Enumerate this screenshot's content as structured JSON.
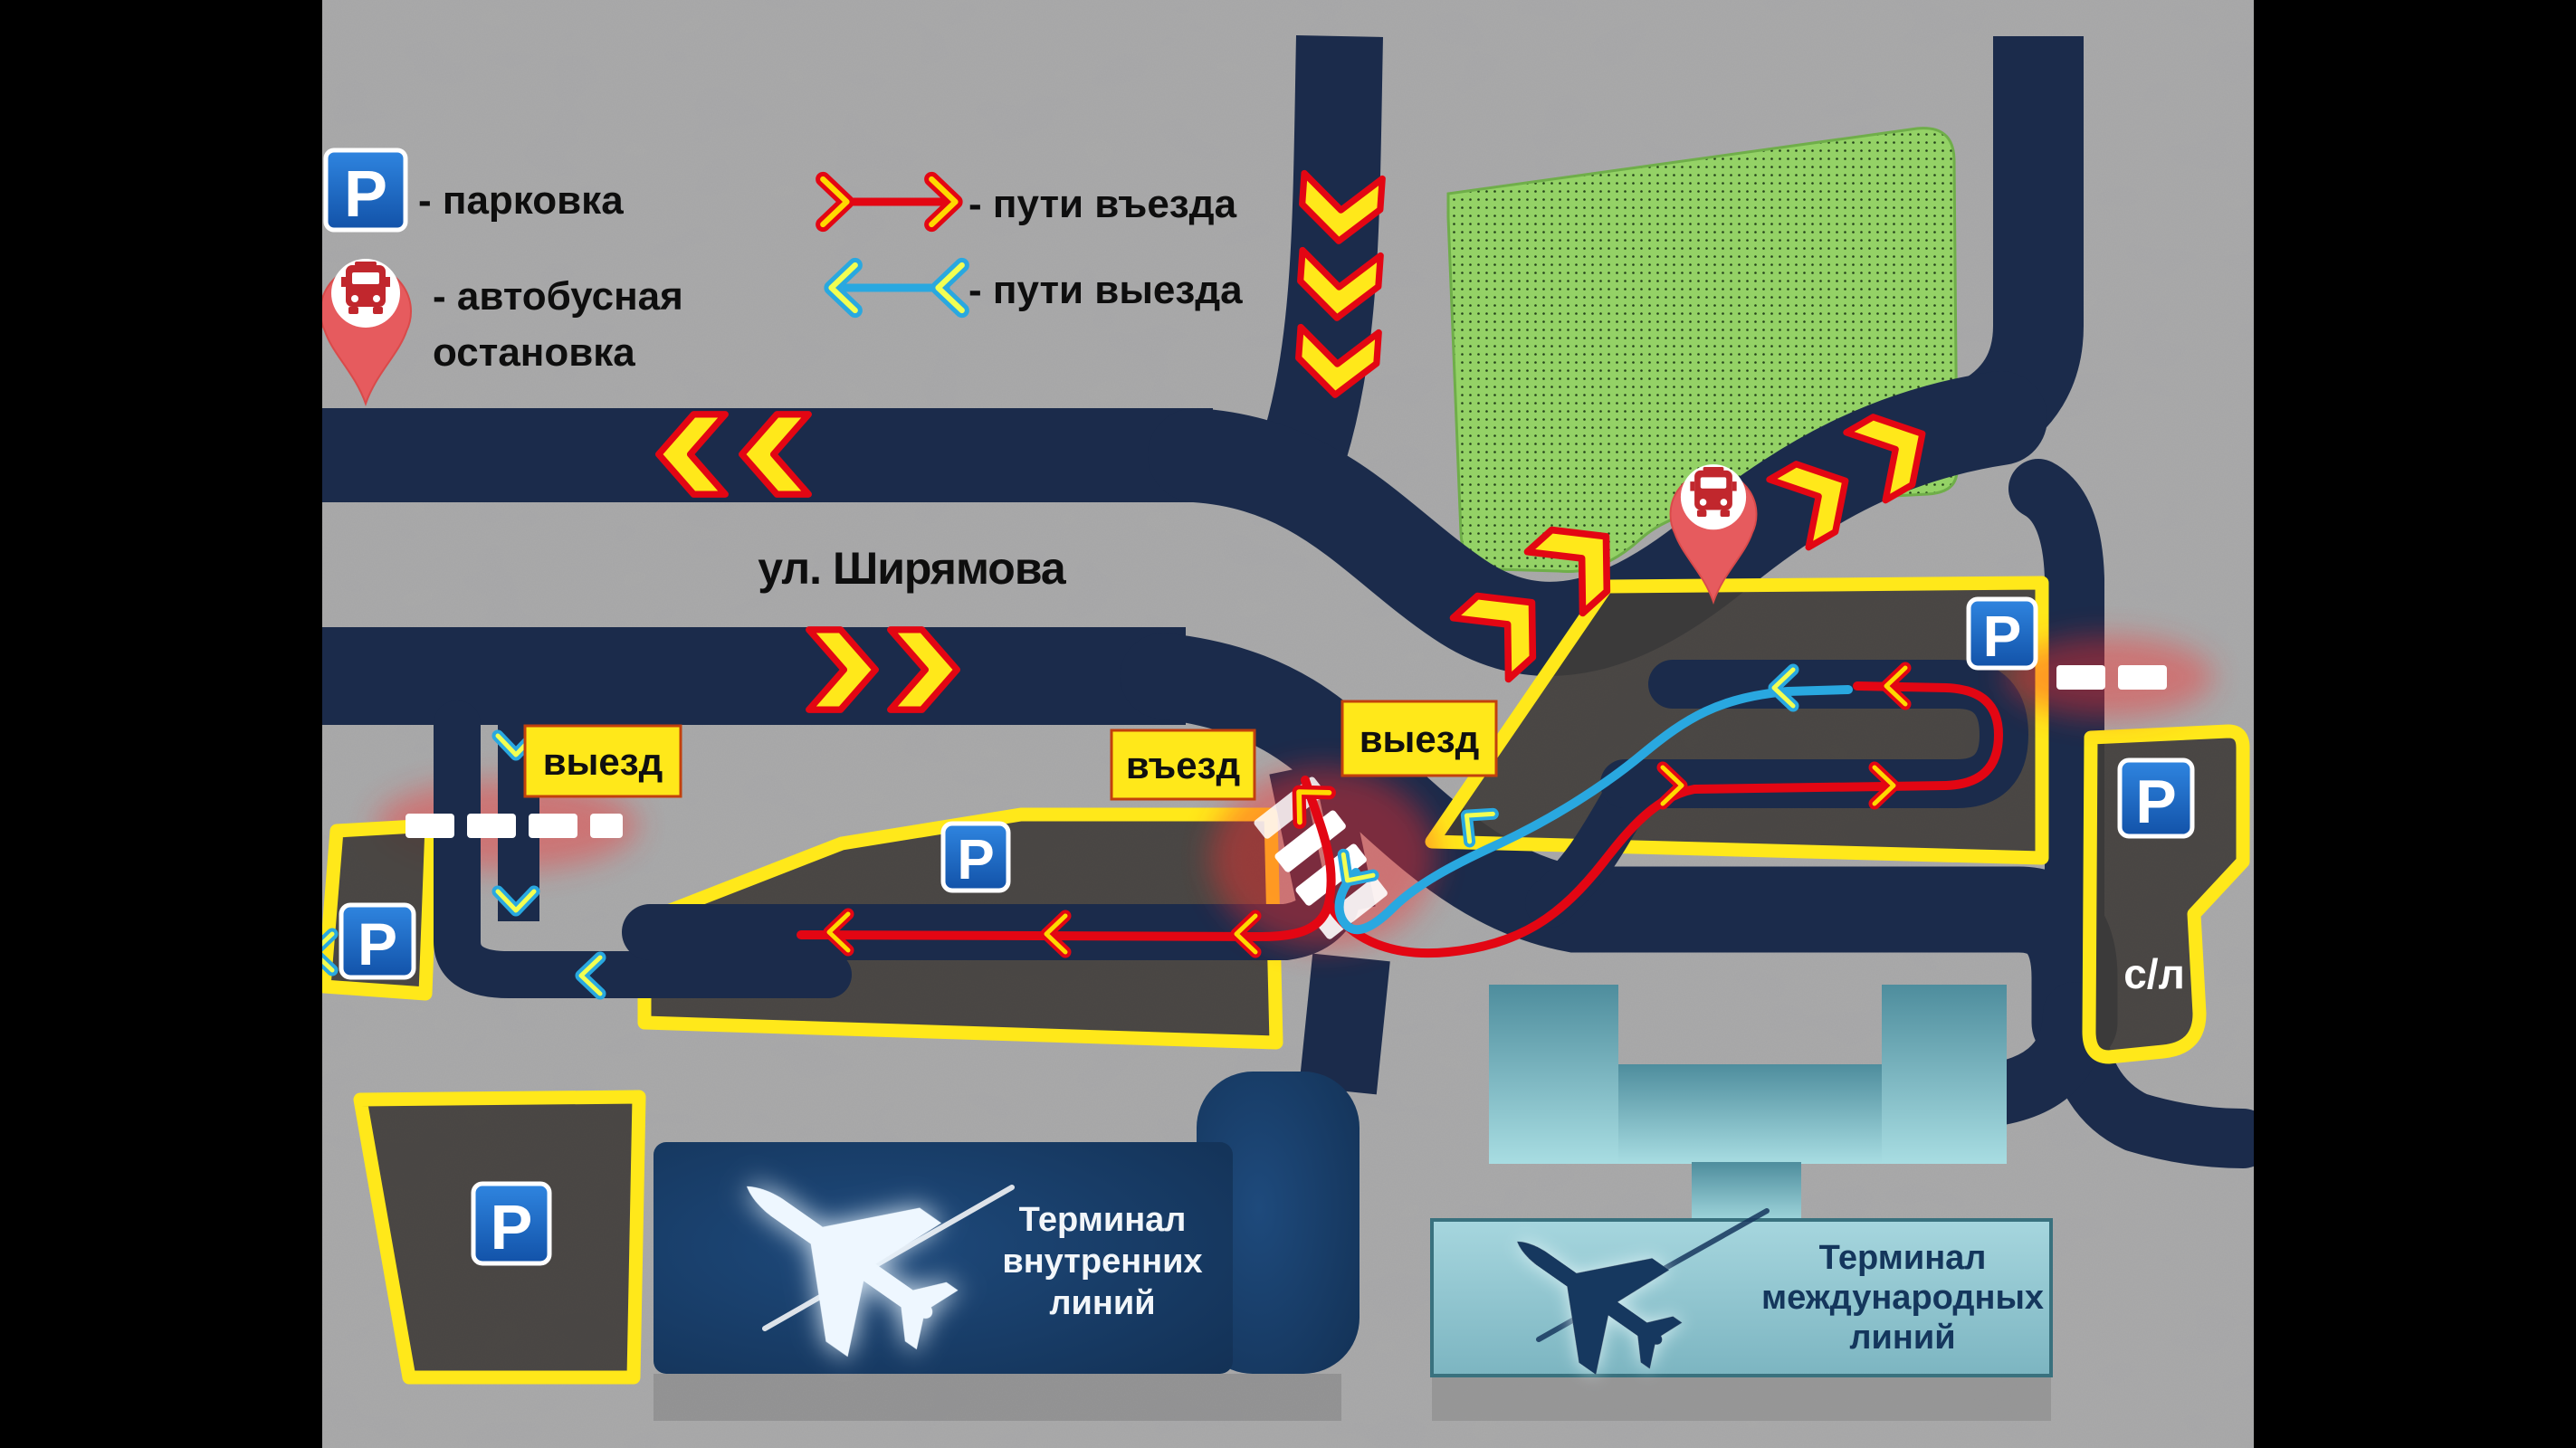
{
  "legend": {
    "parking_label": "- парковка",
    "bus_label_line1": "- автобусная",
    "bus_label_line2": "остановка",
    "entry_label": "- пути въезда",
    "exit_label": "- пути выезда"
  },
  "street": {
    "name": "ул. Ширямова"
  },
  "labels": {
    "parking_letter": "P",
    "exit_left": "выезд",
    "entry_center": "въезд",
    "exit_center": "выезд",
    "service_lot": "с/л"
  },
  "terminals": {
    "domestic": {
      "lines": [
        "Терминал",
        "внутренних",
        "линий"
      ]
    },
    "international": {
      "lines": [
        "Терминал",
        "международных",
        "линий"
      ]
    }
  },
  "colors": {
    "road": "#1b2b4b",
    "accent_yellow": "#ffe81a",
    "entry_red": "#e30613",
    "exit_blue": "#29a8e0",
    "green_zone": "#94d266",
    "teal_terminal": "#8ec6d0",
    "domestic_terminal": "#17375e",
    "parking_sign_blue": "#1a63cc",
    "bus_pin_red": "#e65b5e"
  }
}
